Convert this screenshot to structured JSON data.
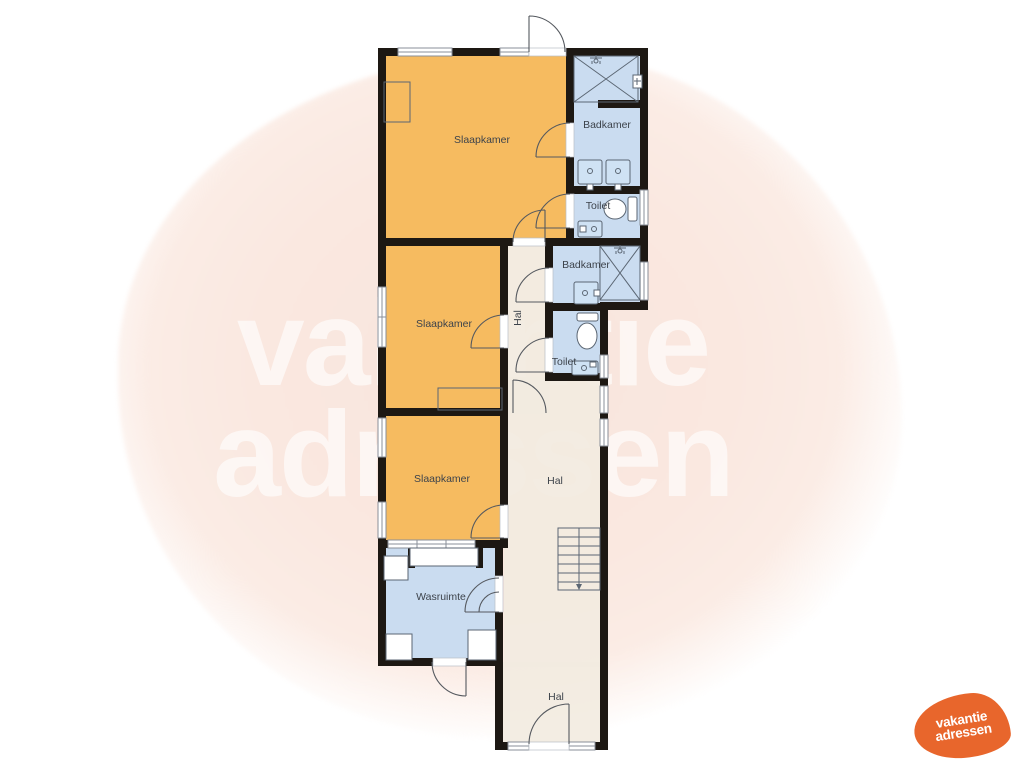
{
  "watermark": {
    "line1": "vakantie",
    "line2": "adressen"
  },
  "logo": {
    "line1": "vakantie",
    "line2": "adressen",
    "color": "#e8662c"
  },
  "colors": {
    "bedroom": "#f6bb60",
    "wet": "#cadcf0",
    "hall": "#f2ebe0",
    "wall": "#1d1813",
    "label": "#3d434b",
    "fixture": "#5b6673",
    "blob": "#fae8e0"
  },
  "rooms": [
    {
      "id": "slaapkamer-1",
      "label": "Slaapkamer"
    },
    {
      "id": "badkamer-1",
      "label": "Badkamer"
    },
    {
      "id": "toilet-1",
      "label": "Toilet"
    },
    {
      "id": "slaapkamer-2",
      "label": "Slaapkamer"
    },
    {
      "id": "hal-corridor",
      "label": "Hal"
    },
    {
      "id": "badkamer-2",
      "label": "Badkamer"
    },
    {
      "id": "toilet-2",
      "label": "Toilet"
    },
    {
      "id": "slaapkamer-3",
      "label": "Slaapkamer"
    },
    {
      "id": "hal-main",
      "label": "Hal"
    },
    {
      "id": "wasruimte",
      "label": "Wasruimte"
    },
    {
      "id": "hal-entry",
      "label": "Hal"
    }
  ]
}
